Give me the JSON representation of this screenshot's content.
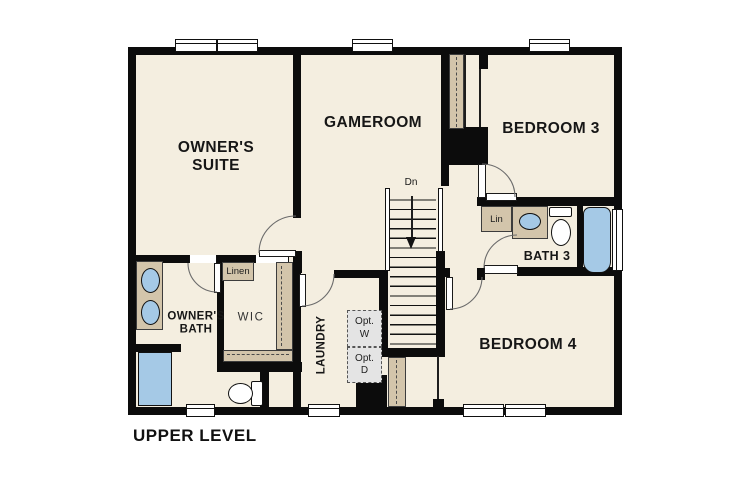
{
  "title": "UPPER LEVEL",
  "labels": {
    "owners_suite": "OWNER'S\nSUITE",
    "gameroom": "GAMEROOM",
    "bedroom3": "BEDROOM 3",
    "bedroom4": "BEDROOM 4",
    "bath3": "BATH 3",
    "owners_bath": "OWNER'S\nBATH",
    "wic": "WIC",
    "laundry": "LAUNDRY",
    "linen": "Linen",
    "lin": "Lin",
    "opt_washer": "Opt.\nW",
    "opt_dryer": "Opt.\nD",
    "stairs_down": "Dn",
    "plan_title": "UPPER LEVEL"
  },
  "colors": {
    "wall": "#0c0c0c",
    "floor": "#f4eee0",
    "casework_tan": "#d3c5ab",
    "fixture_blue": "#a5c9e6",
    "appliance_gray": "#e4e4e4"
  }
}
